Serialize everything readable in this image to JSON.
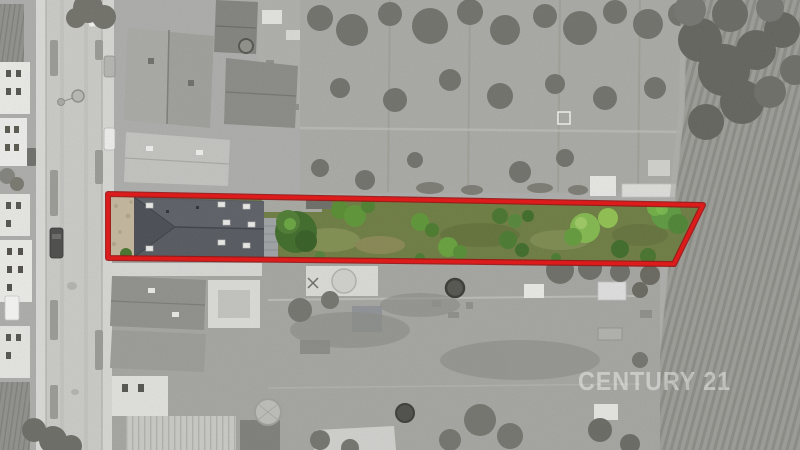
{
  "page": {
    "watermark": "CENTURY 21"
  },
  "parcel": {
    "label": "highlighted parcel for sale",
    "boundary_color": "#e21414",
    "boundary_outline_color": "#9a0d0d",
    "lawn_color": "#6d7c42",
    "roof_color": "#565a60",
    "roof_hip_color": "#4a4e54",
    "yard_color": "#c3b69c",
    "tree_dark": "#3f6b2a",
    "tree_mid": "#5d9537",
    "tree_light": "#82b84e"
  },
  "photo": {
    "base_gray": "#acacaa",
    "road_gray": "#c9c9c6",
    "sidewalk_gray": "#d8d8d5",
    "building_white": "#e9e9e6",
    "roof_gray": "#9e9e9a",
    "field_gray": "#9c9c97",
    "field_furrow_gray": "#8b8b86",
    "tree_gray": "#71716b",
    "watermark_color": "#ffffff",
    "watermark_opacity": "0.42"
  }
}
